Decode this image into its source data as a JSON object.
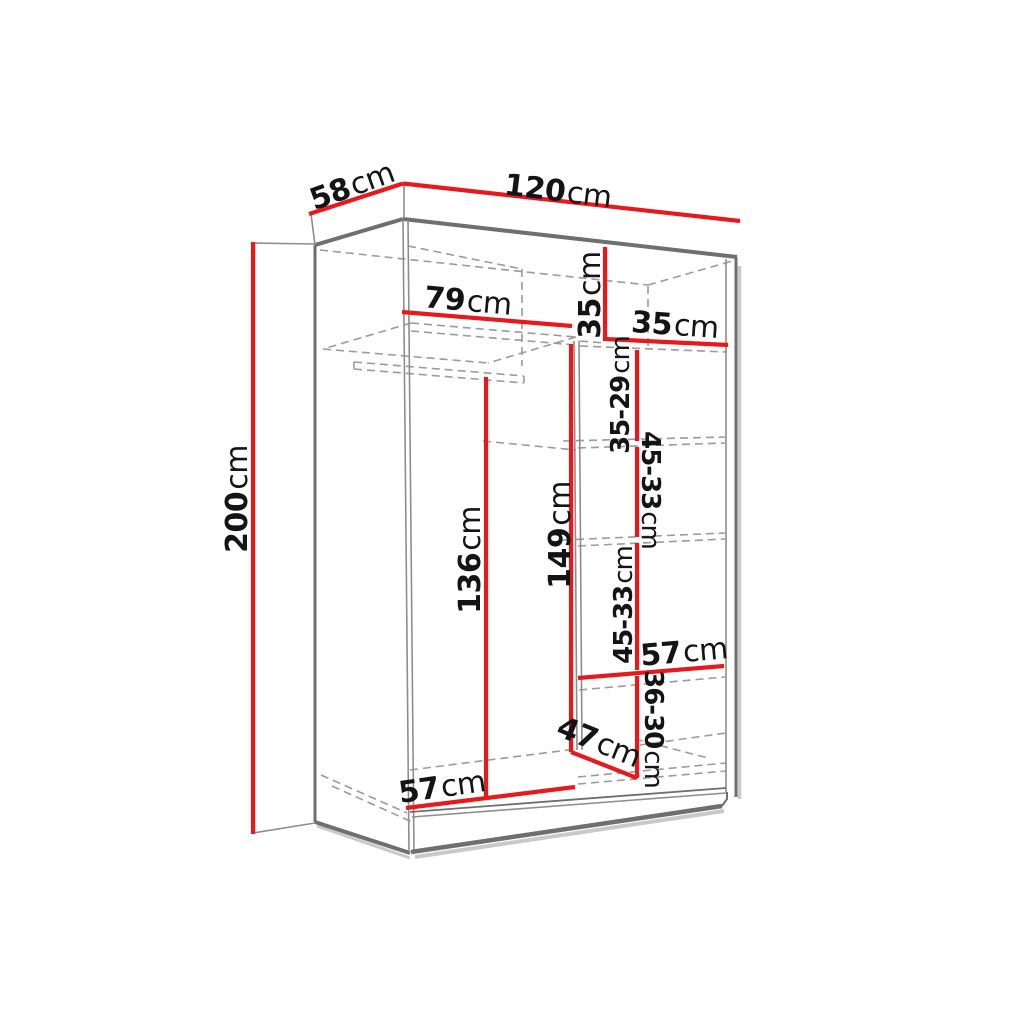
{
  "unit": "cm",
  "colors": {
    "dimension_red": "#e8191c",
    "carcass_gray": "#6f6f6f",
    "hidden_line_gray": "#9b9b9b",
    "text_black": "#141414",
    "background": "#ffffff"
  },
  "dims": {
    "depth": {
      "value": "58",
      "unit": "cm"
    },
    "width": {
      "value": "120",
      "unit": "cm"
    },
    "height": {
      "value": "200",
      "unit": "cm"
    },
    "top_shelf_width": {
      "value": "79",
      "unit": "cm"
    },
    "top_right_height": {
      "value": "35",
      "unit": "cm"
    },
    "top_right_width": {
      "value": "35",
      "unit": "cm"
    },
    "right_compartment_1": {
      "value": "35-29",
      "unit": "cm"
    },
    "right_compartment_2": {
      "value": "45-33",
      "unit": "cm"
    },
    "right_compartment_3": {
      "value": "45-33",
      "unit": "cm"
    },
    "right_shelf_width": {
      "value": "57",
      "unit": "cm"
    },
    "right_compartment_4": {
      "value": "36-30",
      "unit": "cm"
    },
    "bottom_depth": {
      "value": "47",
      "unit": "cm"
    },
    "bottom_shelf_width": {
      "value": "57",
      "unit": "cm"
    },
    "hanging_height": {
      "value": "136",
      "unit": "cm"
    },
    "middle_height": {
      "value": "149",
      "unit": "cm"
    }
  }
}
